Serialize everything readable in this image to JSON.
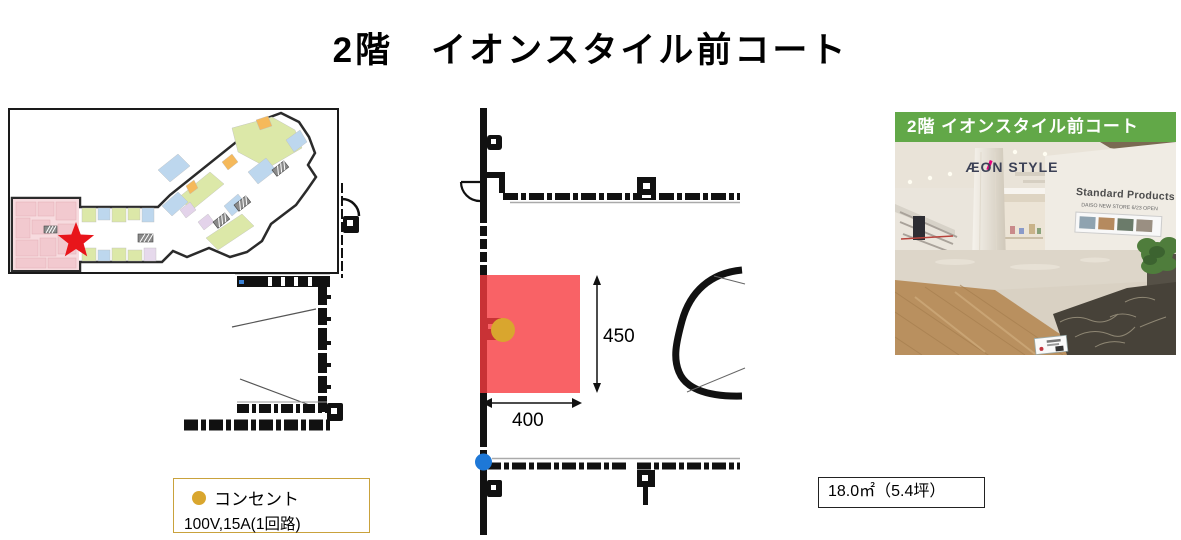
{
  "title": "2階　イオンスタイル前コート",
  "colors": {
    "header_green": "#62A848",
    "highlight_red": "#F83B40",
    "star_red": "#E8151B",
    "outlet_gold": "#D9A62E",
    "legend_border": "#C9A23C",
    "marker_blue": "#1E78D7"
  },
  "detail_plan": {
    "dim_height": "450",
    "dim_width": "400"
  },
  "photo": {
    "header": "2階 イオンスタイル前コート",
    "store_sign": "ÆON STYLE",
    "wall_sign_line1": "Standard Products",
    "wall_sign_line2": "DAISO NEW STORE 6/23 OPEN"
  },
  "legend": {
    "label": "コンセント",
    "spec": "100V,15A(1回路)"
  },
  "area_note": "18.0㎡（5.4坪）"
}
